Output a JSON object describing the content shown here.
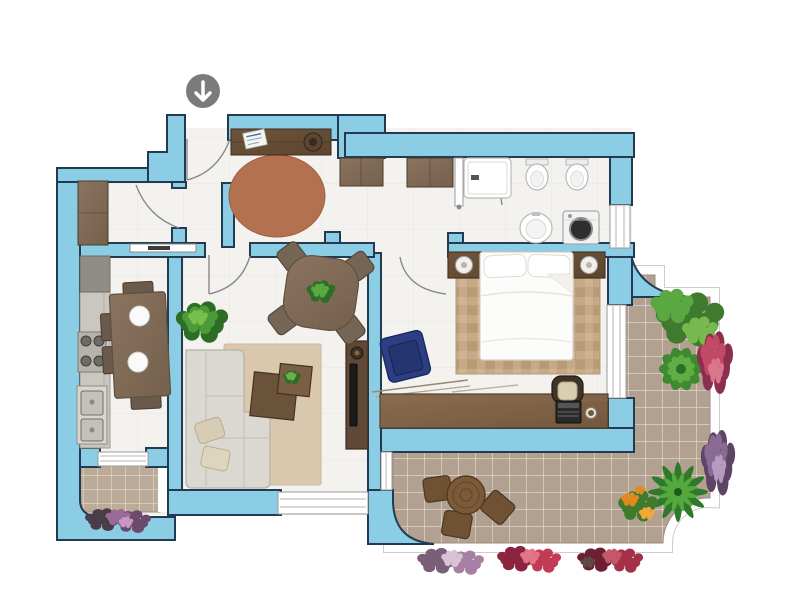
{
  "icons": {
    "entrance_arrow_icon": "arrow-down"
  },
  "palette": {
    "wall_fill": "#8BCDE4",
    "wall_outline": "#223B50",
    "floor": "#F3F2EF",
    "terrace_tile": "#B2A191",
    "balcony_tile": "#BCAB99",
    "tile_grout": "#E6DCCE",
    "entry_rug": "#B4714F",
    "living_rug": "#D9C8AD",
    "bedroom_rug": "#C6A987",
    "wood_dark": "#6B5138",
    "wood_medium": "#7C6148",
    "wood_light": "#95816F",
    "sofa": "#DBD8D1",
    "bed": "#FCFCFA",
    "armchair_blue": "#2C3F85",
    "counter_gray": "#C9C7C0",
    "plant_green": "#4D9A38",
    "plant_green_dark": "#2E6D26",
    "plant_green_light": "#79BF4E",
    "flower_pink": "#C14A66",
    "flower_purple": "#9A6B99",
    "flower_orange": "#E08A1F",
    "arrow_badge": "#7B7B7B",
    "outside": "#FFFFFF"
  },
  "inventory": {
    "entry": [
      "entrance-arrow-badge",
      "entry-door",
      "console-table",
      "decor-bowl",
      "notepad",
      "round-rug",
      "sideboard",
      "sideboard-2",
      "hall-wardrobe"
    ],
    "bathroom": [
      "shower",
      "bidet",
      "toilet",
      "pedestal-sink",
      "washing-machine",
      "bathroom-door",
      "bathroom-window"
    ],
    "kitchen": [
      "counter",
      "cooktop",
      "double-sink",
      "dining-table",
      "chairs",
      "plates",
      "pocket-door",
      "balcony",
      "balcony-flowers"
    ],
    "living_room": [
      "l-sofa",
      "throw-pillows",
      "area-rug",
      "coffee-tables",
      "potted-plant",
      "tv-console",
      "tv",
      "window"
    ],
    "dining_nook": [
      "square-table",
      "corner-chairs",
      "centerpiece-plant"
    ],
    "bedroom": [
      "double-bed",
      "pillows",
      "headboard",
      "nightstands",
      "lamps",
      "bed-rug",
      "blue-armchair",
      "desk",
      "desk-chair",
      "laptop",
      "cup",
      "bedroom-door",
      "bedroom-window"
    ],
    "terrace": [
      "tiled-deck",
      "round-table",
      "stools",
      "shrub",
      "leafy-plant",
      "palm-plant",
      "flower-beds",
      "orange-flowers"
    ]
  }
}
